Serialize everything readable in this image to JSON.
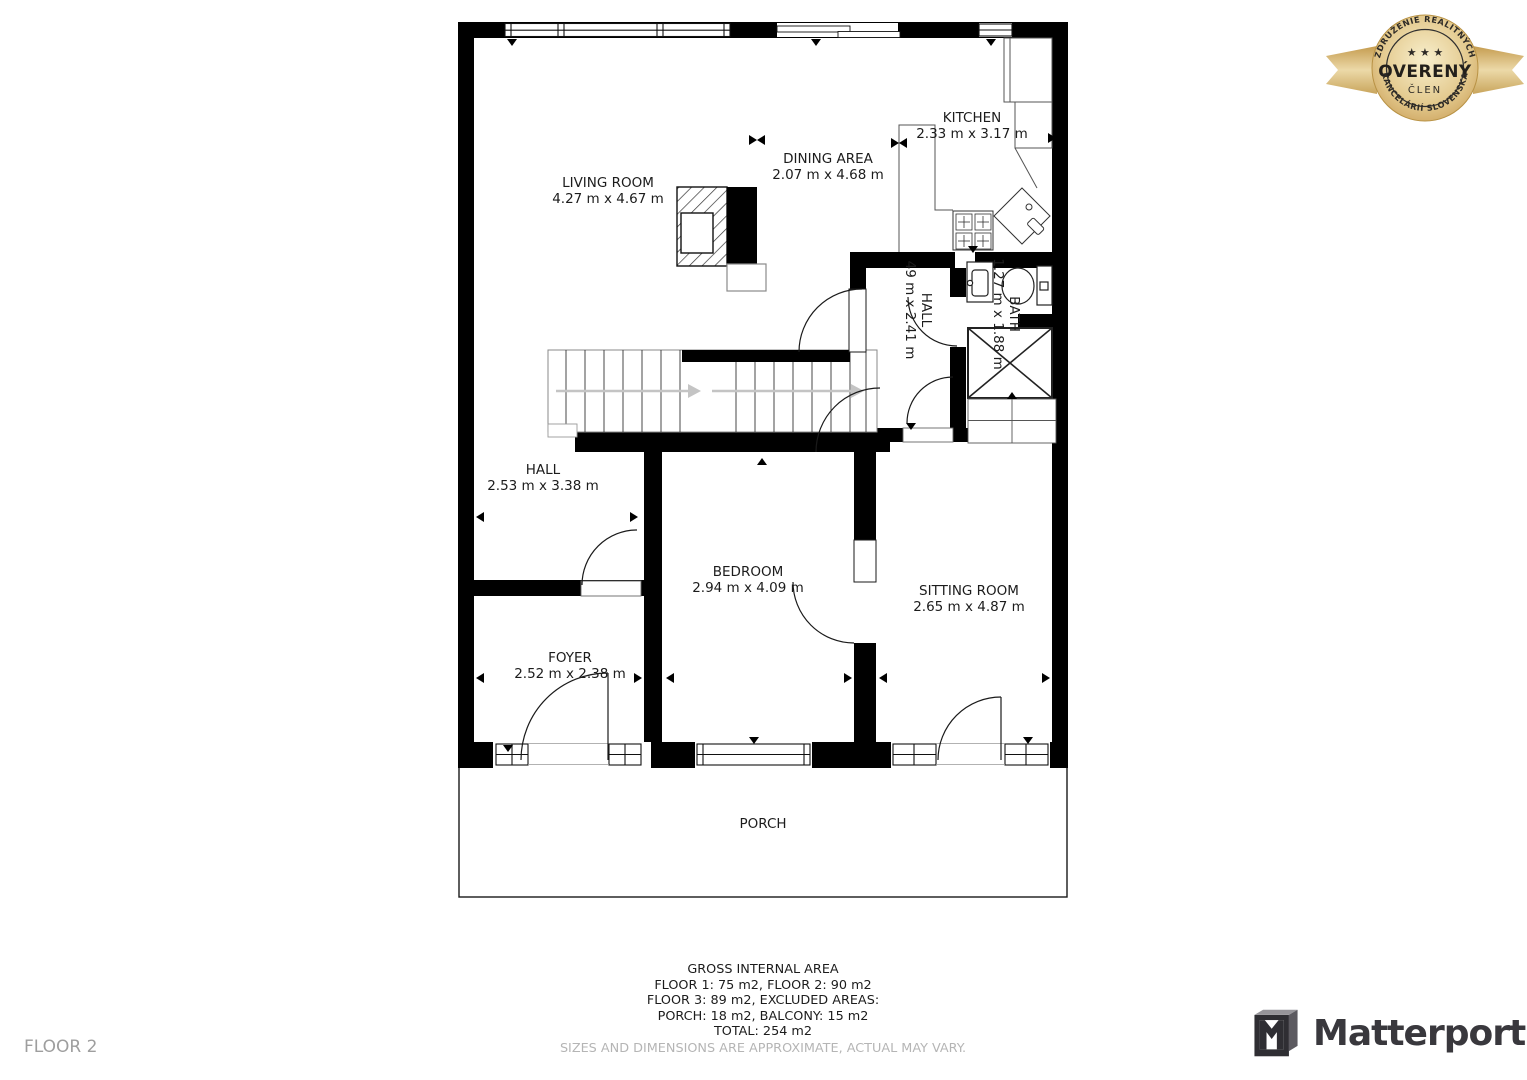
{
  "floor_plan": {
    "rooms": [
      {
        "name": "LIVING ROOM",
        "dims": "4.27 m x 4.67 m"
      },
      {
        "name": "DINING AREA",
        "dims": "2.07 m x 4.68 m"
      },
      {
        "name": "KITCHEN",
        "dims": "2.33 m x 3.17 m"
      },
      {
        "name": "HALL",
        "dims": "49 m x 2.41 m"
      },
      {
        "name": "BATH",
        "dims": "1.27 m x 1.88 m"
      },
      {
        "name": "HALL",
        "dims": "2.53 m x 3.38 m"
      },
      {
        "name": "BEDROOM",
        "dims": "2.94 m x 4.09 m"
      },
      {
        "name": "SITTING ROOM",
        "dims": "2.65 m x 4.87 m"
      },
      {
        "name": "FOYER",
        "dims": "2.52 m x 2.38 m"
      },
      {
        "name": "PORCH",
        "dims": ""
      }
    ]
  },
  "footer": {
    "title": "GROSS INTERNAL AREA",
    "line1": "FLOOR 1: 75 m2, FLOOR 2: 90 m2",
    "line2": "FLOOR 3: 89 m2, EXCLUDED AREAS:",
    "line3": "PORCH: 18 m2, BALCONY: 15 m2",
    "line4": "TOTAL: 254 m2",
    "disclaimer": "SIZES AND DIMENSIONS ARE APPROXIMATE, ACTUAL MAY VARY."
  },
  "floor_label": "FLOOR 2",
  "badge": {
    "arc_top": "ZDRUŽENIE REALITNÝCH",
    "stars": "★ ★ ★",
    "title": "OVERENÝ",
    "subtitle": "ČLEN",
    "arc_bottom": "KANCELÁRIÍ SLOVENSKA"
  },
  "logo": {
    "text": "Matterport"
  },
  "colors": {
    "wall": "#000000",
    "badge_gold": "#d9b878",
    "logo_dark": "#39383d",
    "muted_text": "#b5b5b5"
  }
}
